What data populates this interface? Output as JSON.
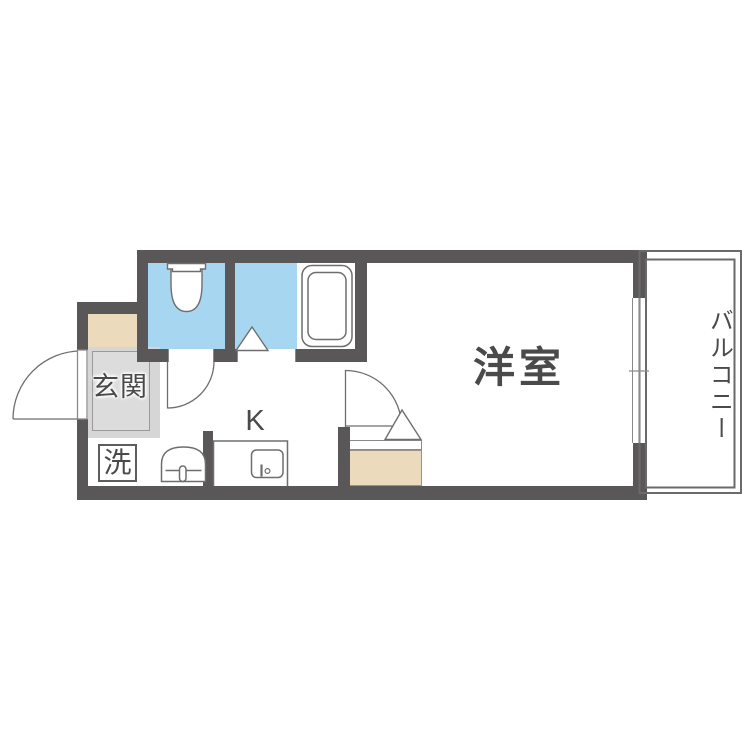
{
  "floor_plan": {
    "type": "japanese-apartment-floor-plan",
    "labels": {
      "entrance": "玄関",
      "laundry": "洗",
      "kitchen": "K",
      "western_room": "洋室",
      "balcony": "バルコニー"
    },
    "fixtures": [
      {
        "icon": "toilet-icon"
      },
      {
        "icon": "bathtub-icon"
      },
      {
        "icon": "washbasin-icon"
      },
      {
        "icon": "kitchen-sink-icon"
      },
      {
        "icon": "door-swing-arc-icon"
      },
      {
        "icon": "door-triangle-icon"
      },
      {
        "icon": "sliding-window-icon"
      }
    ],
    "colors": {
      "wall": "#595757",
      "wet_area": "#a7d7f0",
      "step": "#ecdabd",
      "entrance_floor": "#d6d6d6",
      "entrance_floor_inner": "#dcdcdc",
      "line": "#6e6e6e",
      "text": "#4a4a4a",
      "background": "#ffffff"
    }
  }
}
